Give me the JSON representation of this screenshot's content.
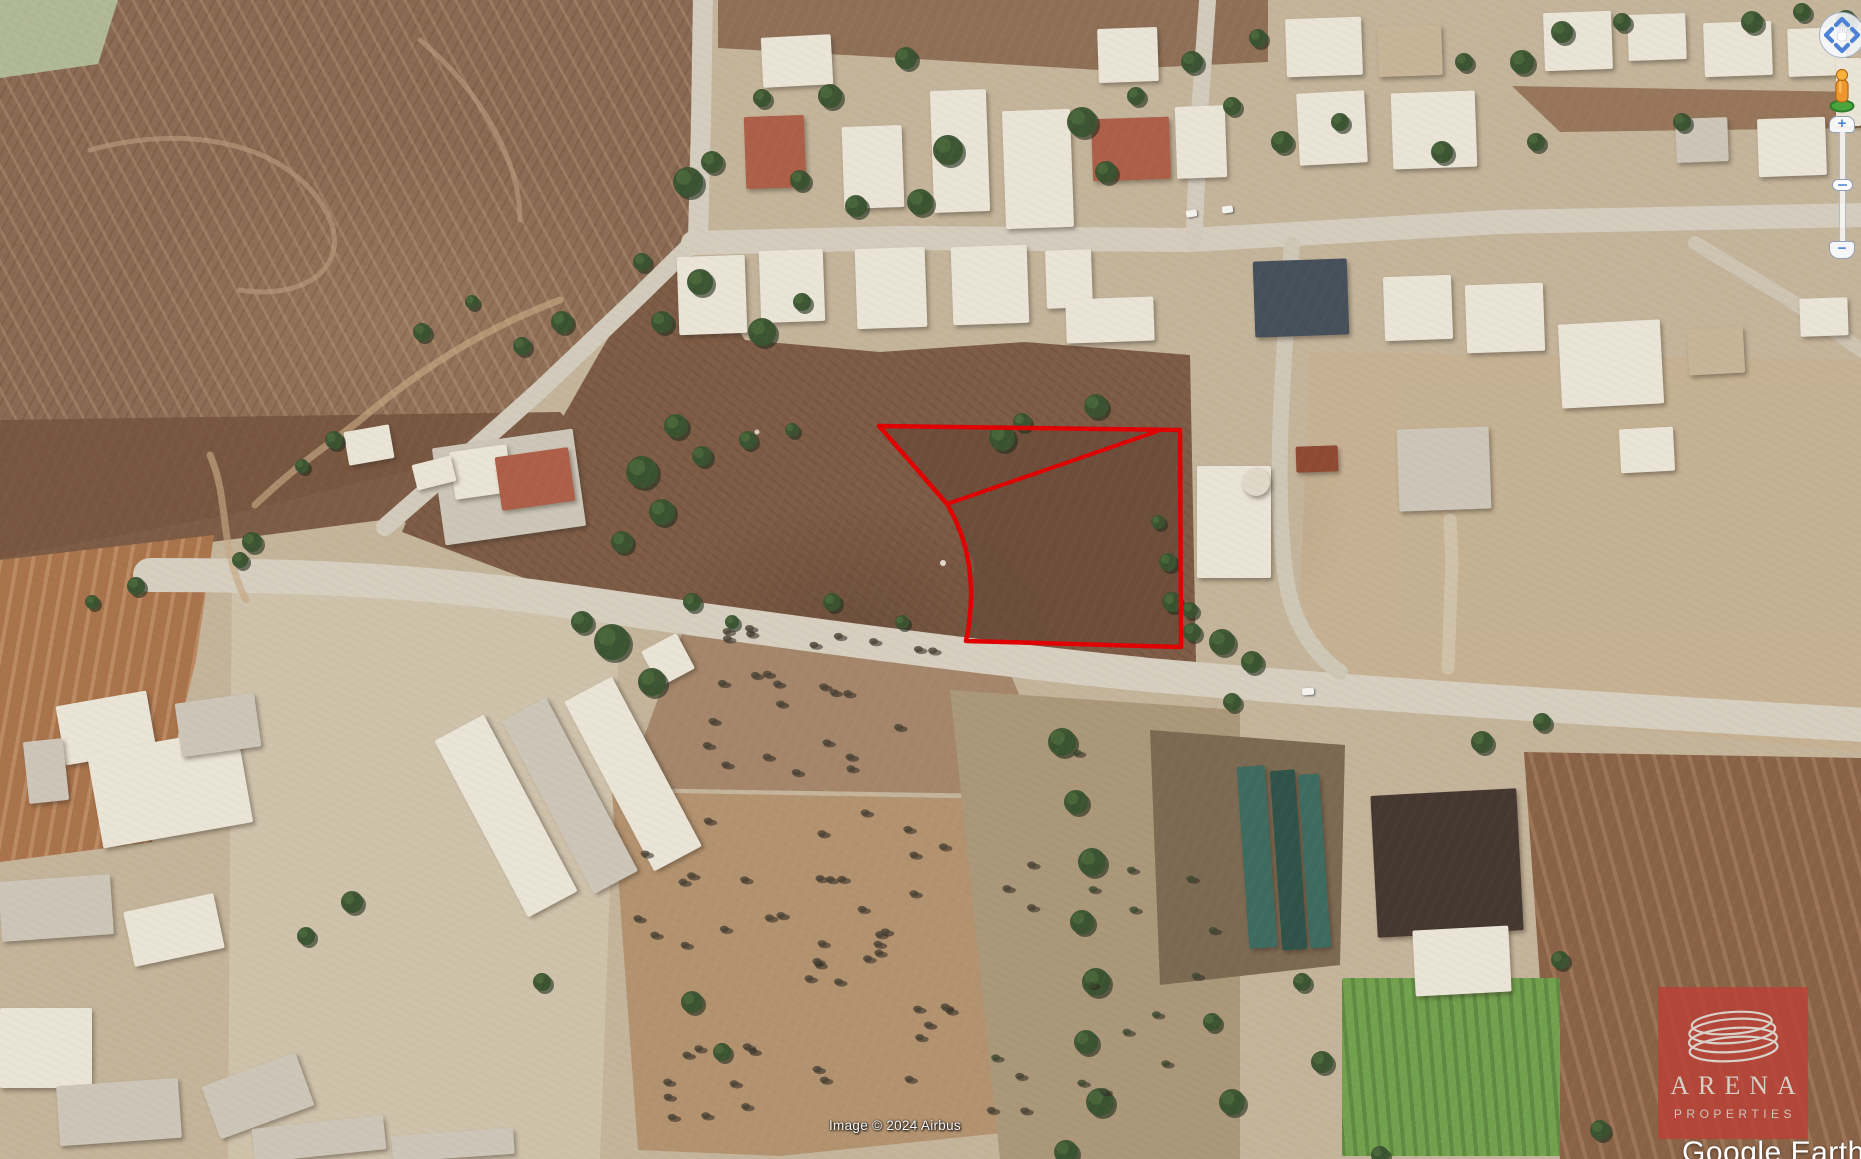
{
  "app": {
    "name": "Google Earth"
  },
  "map": {
    "attribution": "Image © 2024 Airbus",
    "brand_watermark": "Google Earth",
    "overlay": {
      "description": "property plot boundary",
      "color": "#e10000",
      "stroke_width": 4.5,
      "outer_boundary": [
        [
          879,
          426
        ],
        [
          1180,
          430
        ],
        [
          1181,
          647
        ],
        [
          966,
          641
        ]
      ],
      "arc_control": [
        982,
        563
      ],
      "arc_end": [
        947,
        504
      ],
      "divider_line": [
        [
          947,
          504
        ],
        [
          1158,
          431
        ]
      ]
    }
  },
  "watermark_logo": {
    "title": "ARENA",
    "subtitle": "PROPERTIES",
    "bg": "rgba(187,64,54,0.82)",
    "ring_color": "#d8d1c8"
  },
  "controls": {
    "zoom_in_label": "+",
    "zoom_out_label": "−"
  }
}
